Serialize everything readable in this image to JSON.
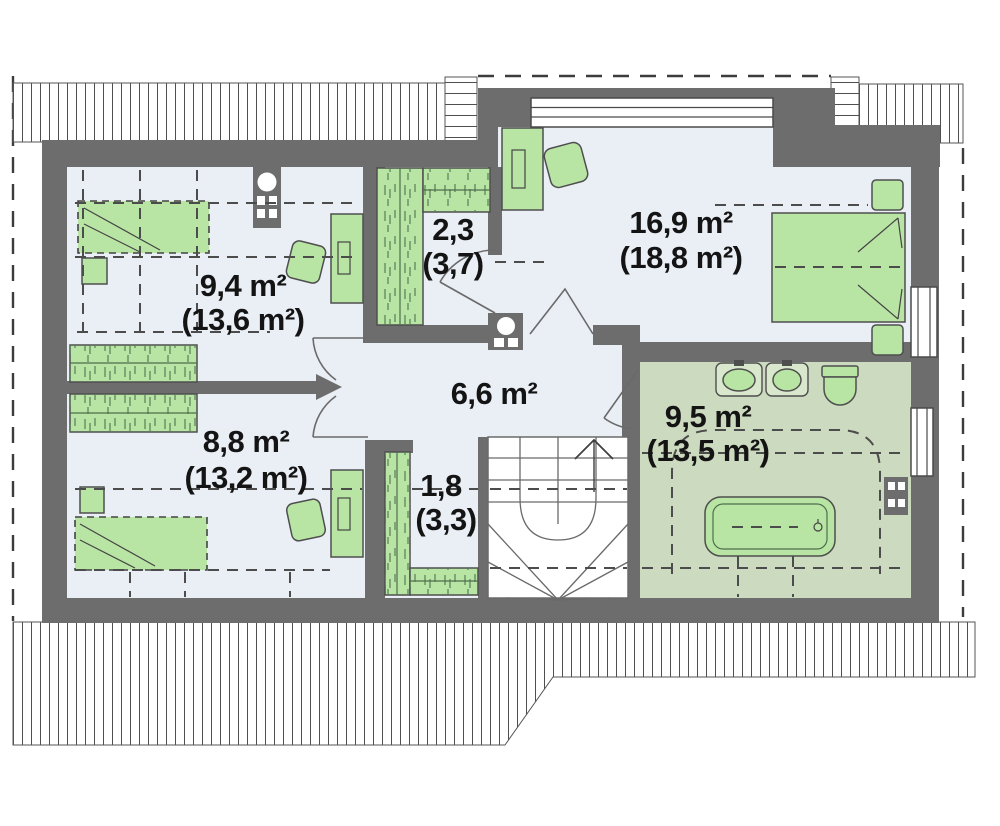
{
  "plan_type": "attic floor plan",
  "rooms": {
    "room_top_left": {
      "area": "9,4 m²",
      "area_total": "(13,6 m²)"
    },
    "closet_top": {
      "area": "2,3",
      "area_total": "(3,7)"
    },
    "bedroom_right": {
      "area": "16,9 m²",
      "area_total": "(18,8 m²)"
    },
    "hallway": {
      "area": "6,6 m²"
    },
    "room_bottom_left": {
      "area": "8,8 m²",
      "area_total": "(13,2 m²)"
    },
    "closet_bottom": {
      "area": "1,8",
      "area_total": "(3,3)"
    },
    "bathroom": {
      "area": "9,5 m²",
      "area_total": "(13,5 m²)"
    }
  },
  "icons": {
    "bed": "bed-symbol",
    "double_bed": "double-bed-symbol",
    "wardrobe": "wardrobe-hatched-symbol",
    "desk": "desk-symbol",
    "chair": "chair-symbol",
    "nightstand": "nightstand-symbol",
    "sink": "sink-symbol",
    "toilet": "toilet-symbol",
    "bathtub": "bathtub-symbol",
    "chimney": "chimney-flue-symbol",
    "stairs": "winder-stairs-symbol",
    "window": "window-symbol",
    "roof": "roof-hatch",
    "door": "door-swing-arc"
  },
  "colors": {
    "wall": "#6d6d6d",
    "floor": "#eaeef5",
    "bathroom_floor": "#ccdabf",
    "furniture": "#b9e5a4",
    "furniture_outline": "#4e4e4e"
  }
}
